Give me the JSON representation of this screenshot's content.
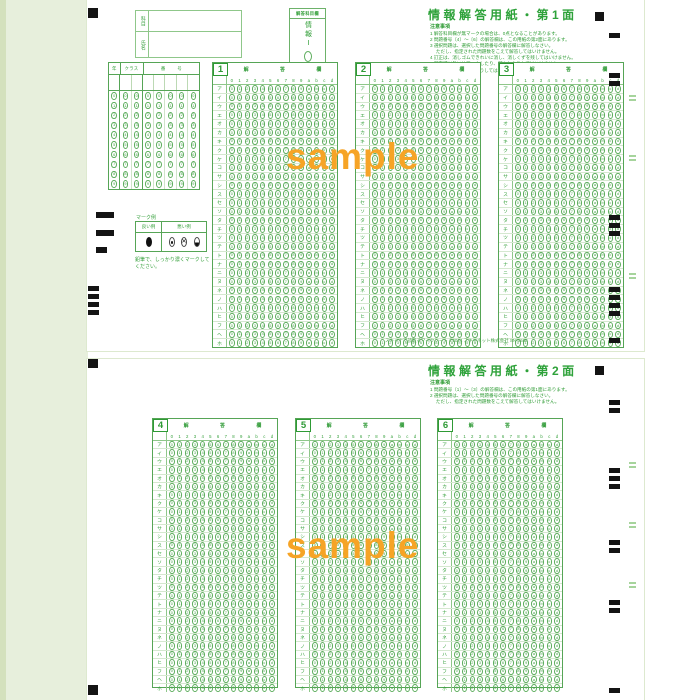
{
  "watermark": "sample",
  "footer": "スキャナで読取るマークシート ©2024 スキャネット株式会社 SN-0688",
  "colors": {
    "print_green": "#35a03b",
    "light_green_border": "#bcd9b4",
    "pale_green_bg": "#e7efdc",
    "watermark_orange": "#f6a426",
    "timing_mark_black": "#141414"
  },
  "grid": {
    "header": "解 答 欄",
    "col_labels": [
      "0",
      "1",
      "2",
      "3",
      "4",
      "5",
      "6",
      "7",
      "8",
      "9",
      "a",
      "b",
      "c",
      "d"
    ],
    "row_labels": [
      "ア",
      "イ",
      "ウ",
      "エ",
      "オ",
      "カ",
      "キ",
      "ク",
      "ケ",
      "コ",
      "サ",
      "シ",
      "ス",
      "セ",
      "ソ",
      "タ",
      "チ",
      "ツ",
      "テ",
      "ト",
      "ナ",
      "ニ",
      "ヌ",
      "ネ",
      "ノ",
      "ハ",
      "ヒ",
      "フ",
      "ヘ",
      "ホ"
    ]
  },
  "page1": {
    "title": "情報解答用紙・第1面",
    "subject_label": "科目",
    "name_label": "氏名",
    "answer_subject_box": {
      "label": "解答科目欄",
      "subject": "情報Ⅰ"
    },
    "notes_title": "注意事項",
    "notes": [
      "1 解答科目欄が無マークの場合は、0点となることがあります。",
      "2 問題番号〔4〕～〔6〕の解答欄は、この用紙の第2面にあります。",
      "3 選択問題は、選択した問題番号の解答欄に解答しなさい。",
      "　 ただし、指定された問題数をこえて解答してはいけません。",
      "4 訂正は、消しゴムできれいに消し、消しくずを残してはいけません。",
      "5 所定欄以外にはマークしたり、記入したりしてはいけません。",
      "6 汚したり、折りまげたりしてはいけません。"
    ],
    "id_grid": {
      "year_label": "年",
      "class_label": "クラス",
      "number_label": "番号",
      "digits": [
        "0",
        "1",
        "2",
        "3",
        "4",
        "5",
        "6",
        "7",
        "8",
        "9"
      ]
    },
    "mark_example": {
      "title": "マーク例",
      "good_label": "良い例",
      "bad_label": "悪い例",
      "note": "鉛筆で、しっかり濃くマークしてください。"
    },
    "blocks": [
      {
        "no": "1"
      },
      {
        "no": "2"
      },
      {
        "no": "3"
      }
    ]
  },
  "page2": {
    "title": "情報解答用紙・第2面",
    "notes_title": "注意事項",
    "notes": [
      "1 問題番号〔1〕～〔3〕の解答欄は、この用紙の第1面にあります。",
      "2 選択問題は、選択した問題番号の解答欄に解答しなさい。",
      "　 ただし、指定された問題数をこえて解答してはいけません。"
    ],
    "blocks": [
      {
        "no": "4"
      },
      {
        "no": "5"
      },
      {
        "no": "6"
      }
    ]
  }
}
